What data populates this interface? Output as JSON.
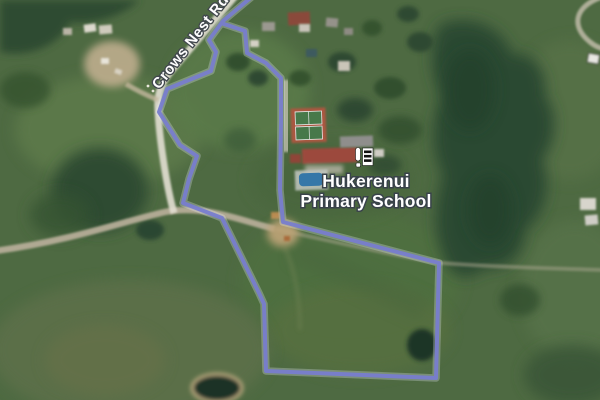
{
  "map": {
    "road_label": "Crows Nest Rd",
    "poi": {
      "name_line1": "Hukerenui",
      "name_line2": "Primary School",
      "icon": "school-icon"
    },
    "overlay": {
      "kind": "parcel-boundary",
      "color": "#787dce",
      "halo_color": "rgba(235,238,255,0.28)"
    },
    "colors": {
      "field_green": "#4e6a42",
      "forest_green": "#2c4832",
      "bush_dark": "#2f4c33",
      "road_tan": "#b6ad98",
      "road_white": "#e3dfd3",
      "court_clay": "#ab5740",
      "court_green": "#48794a",
      "pool_blue": "#3577a8",
      "roof_red": "#9c4a3d",
      "label_outline": "#39424a"
    }
  }
}
